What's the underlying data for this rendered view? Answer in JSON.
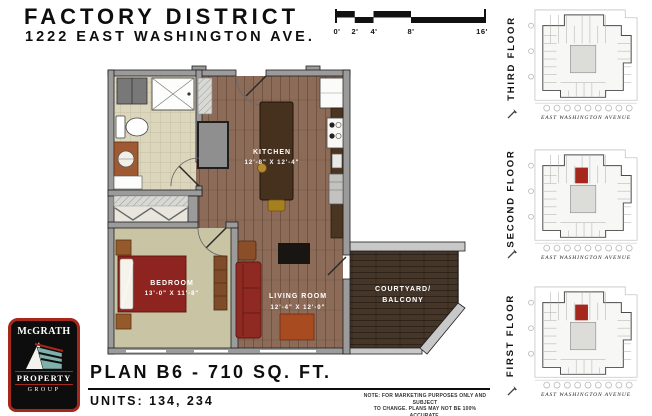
{
  "header": {
    "title": "FACTORY DISTRICT",
    "subtitle": "1222 EAST WASHINGTON AVE."
  },
  "scale_bar": {
    "labels": [
      "0'",
      "2'",
      "4'",
      "8'",
      "16'"
    ]
  },
  "floor_plan": {
    "rooms": {
      "kitchen": {
        "name": "KITCHEN",
        "dims": "12'-8\" X 12'-4\""
      },
      "bedroom": {
        "name": "BEDROOM",
        "dims": "13'-0\" X 11'-8\""
      },
      "living_room": {
        "name": "LIVING ROOM",
        "dims": "12'-4\" X 12'-0\""
      },
      "courtyard": {
        "line1": "COURTYARD/",
        "line2": "BALCONY"
      }
    }
  },
  "key_plans": [
    {
      "label": "THIRD FLOOR",
      "street": "EAST WASHINGTON AVENUE",
      "highlight": false
    },
    {
      "label": "SECOND FLOOR",
      "street": "EAST WASHINGTON AVENUE",
      "highlight": true
    },
    {
      "label": "FIRST FLOOR",
      "street": "EAST WASHINGTON AVENUE",
      "highlight": true
    }
  ],
  "plan_info": {
    "title": "PLAN B6 - 710 SQ. FT.",
    "units": "UNITS: 134, 234",
    "note_line1": "NOTE: FOR MARKETING PURPOSES ONLY AND SUBJECT",
    "note_line2": "TO CHANGE.  PLANS MAY NOT BE 100% ACCURATE."
  },
  "logo": {
    "name": "McGRATH",
    "property": "PROPERTY",
    "group": "GROUP"
  },
  "colors": {
    "highlight_unit_red": "#a6281c",
    "wall_gray": "#9b9b9b",
    "wood_floor": "#8c6c59",
    "tile_floor": "#dbd6bc",
    "carpet_sage": "#c8c4a4",
    "deck_brown": "#463628",
    "furniture_red": "#8e2a22",
    "island_brown": "#46311f",
    "logo_red": "#a6281c"
  }
}
